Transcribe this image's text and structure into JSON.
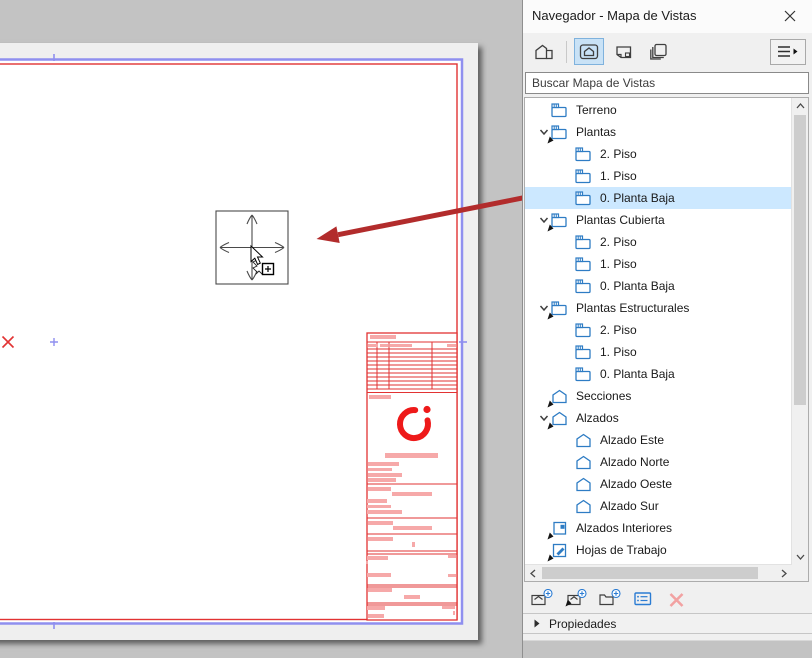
{
  "window": {
    "title": "Navegador - Mapa de Vistas"
  },
  "panel": {
    "search": {
      "placeholder": "Buscar Mapa de Vistas"
    },
    "toolbar": {
      "buttons": [
        {
          "name": "project-map",
          "selected": false
        },
        {
          "name": "view-map",
          "selected": true
        },
        {
          "name": "layout-book",
          "selected": false
        },
        {
          "name": "publisher-sets",
          "selected": false
        }
      ]
    },
    "tree": {
      "items": [
        {
          "label": "Terreno",
          "level": 1,
          "icon": "story",
          "chevron": false,
          "clone": false
        },
        {
          "label": "Plantas",
          "level": 1,
          "icon": "story",
          "chevron": true,
          "clone": true
        },
        {
          "label": "2. Piso",
          "level": 2,
          "icon": "story"
        },
        {
          "label": "1. Piso",
          "level": 2,
          "icon": "story"
        },
        {
          "label": "0. Planta Baja",
          "level": 2,
          "icon": "story",
          "selected": true
        },
        {
          "label": "Plantas Cubierta",
          "level": 1,
          "icon": "story",
          "chevron": true,
          "clone": true
        },
        {
          "label": "2. Piso",
          "level": 2,
          "icon": "story"
        },
        {
          "label": "1. Piso",
          "level": 2,
          "icon": "story"
        },
        {
          "label": "0. Planta Baja",
          "level": 2,
          "icon": "story"
        },
        {
          "label": "Plantas Estructurales",
          "level": 1,
          "icon": "story",
          "chevron": true,
          "clone": true
        },
        {
          "label": "2. Piso",
          "level": 2,
          "icon": "story"
        },
        {
          "label": "1. Piso",
          "level": 2,
          "icon": "story"
        },
        {
          "label": "0. Planta Baja",
          "level": 2,
          "icon": "story"
        },
        {
          "label": "Secciones",
          "level": 1,
          "icon": "house",
          "chevron": false,
          "clone": true
        },
        {
          "label": "Alzados",
          "level": 1,
          "icon": "house",
          "chevron": true,
          "clone": true
        },
        {
          "label": "Alzado Este",
          "level": 2,
          "icon": "house"
        },
        {
          "label": "Alzado Norte",
          "level": 2,
          "icon": "house"
        },
        {
          "label": "Alzado Oeste",
          "level": 2,
          "icon": "house"
        },
        {
          "label": "Alzado Sur",
          "level": 2,
          "icon": "house"
        },
        {
          "label": "Alzados Interiores",
          "level": 1,
          "icon": "interior",
          "chevron": false,
          "clone": true
        },
        {
          "label": "Hojas de Trabajo",
          "level": 1,
          "icon": "worksheet",
          "chevron": false,
          "clone": true
        },
        {
          "label": "",
          "level": 1,
          "icon": "detail",
          "chevron": false,
          "clone": true
        }
      ]
    },
    "footer_toolbar": {
      "buttons": [
        {
          "name": "new-view"
        },
        {
          "name": "clone-folder"
        },
        {
          "name": "new-folder"
        },
        {
          "name": "view-settings"
        },
        {
          "name": "delete"
        }
      ]
    },
    "properties": {
      "label": "Propiedades"
    }
  },
  "colors": {
    "selection": "#cce8ff",
    "tree_icon_blue": "#2e7cc4",
    "layout_purple": "#8f8fef",
    "layout_red": "#e23333",
    "bar_pink": "#f6a9a9",
    "logo_red": "#ee1a1a",
    "annotation_arrow": "#b22c2c"
  },
  "drawing": {
    "page_border": {
      "purple": {
        "x": -10,
        "y": 59.5,
        "w": 472,
        "h": 564,
        "sw": 2.5
      },
      "red": {
        "x": -10,
        "y": 64,
        "w": 467,
        "h": 555.5,
        "sw": 1.4
      }
    },
    "marks": {
      "red_x": {
        "x": 8,
        "y": 342,
        "half": 5.5
      },
      "blue_plus": {
        "x": 54,
        "y": 342,
        "half": 4
      },
      "ticks": [
        {
          "x1": 54,
          "y1": 54,
          "x2": 54,
          "y2": 61
        },
        {
          "x1": 54,
          "y1": 622,
          "x2": 54,
          "y2": 629
        },
        {
          "x1": 459,
          "y1": 342,
          "x2": 467,
          "y2": 342
        }
      ]
    },
    "crosshair": {
      "x": 216,
      "y": 211,
      "w": 72,
      "h": 73
    },
    "cursor": {
      "tip_x": 251,
      "tip_y": 246
    },
    "arrow": {
      "x1": 535,
      "y1": 195.5,
      "x2": 316.5,
      "y2": 239,
      "width": 5,
      "head_len": 22,
      "head_half": 8.5
    },
    "titleblock": {
      "x": 367,
      "y": 333,
      "w": 90,
      "h": 287,
      "hlines": [
        9,
        16,
        20,
        24,
        28,
        32,
        36,
        40,
        44,
        48,
        52,
        56,
        59.5,
        151,
        185,
        201,
        218,
        221,
        252,
        254,
        270,
        272
      ],
      "vlines": [
        {
          "x": 10,
          "y1": 9,
          "y2": 56
        },
        {
          "x": 22,
          "y1": 9,
          "y2": 56
        },
        {
          "x": 65,
          "y1": 9,
          "y2": 56
        }
      ],
      "bars": [
        [
          3,
          2,
          26,
          4
        ],
        [
          1,
          11,
          10,
          3
        ],
        [
          13,
          11,
          8,
          3
        ],
        [
          23,
          11,
          22,
          3
        ],
        [
          80,
          11,
          9,
          3
        ],
        [
          2,
          62,
          22,
          4
        ],
        [
          18,
          120,
          53,
          5
        ],
        [
          1,
          129,
          31,
          4
        ],
        [
          1,
          135,
          24,
          3
        ],
        [
          1,
          140,
          34,
          4
        ],
        [
          1,
          145,
          28,
          4
        ],
        [
          1,
          154,
          23,
          4
        ],
        [
          25,
          159,
          40,
          4
        ],
        [
          0,
          166,
          20,
          4
        ],
        [
          0,
          172,
          24,
          3
        ],
        [
          0,
          177,
          35,
          4
        ],
        [
          1,
          188,
          25,
          4
        ],
        [
          26,
          193,
          39,
          4
        ],
        [
          1,
          204,
          25,
          4
        ],
        [
          45,
          209,
          3,
          5
        ],
        [
          0,
          223,
          21,
          4
        ],
        [
          81,
          222,
          8,
          3
        ],
        [
          -1,
          228,
          2,
          3
        ],
        [
          0,
          240,
          24,
          4
        ],
        [
          81,
          241,
          8,
          3
        ],
        [
          1,
          255,
          24,
          4
        ],
        [
          37,
          262,
          16,
          4
        ],
        [
          0,
          273,
          18,
          4
        ],
        [
          75,
          273,
          13,
          3
        ],
        [
          86,
          278,
          2,
          4
        ],
        [
          1,
          281,
          16,
          4
        ]
      ],
      "logo": {
        "cx": 47,
        "cy": 91,
        "r": 14,
        "stroke_w": 6,
        "start_deg": -15,
        "end_deg": -85,
        "dot": {
          "cx": 60,
          "cy": 76.5,
          "r": 3.6
        }
      }
    }
  }
}
